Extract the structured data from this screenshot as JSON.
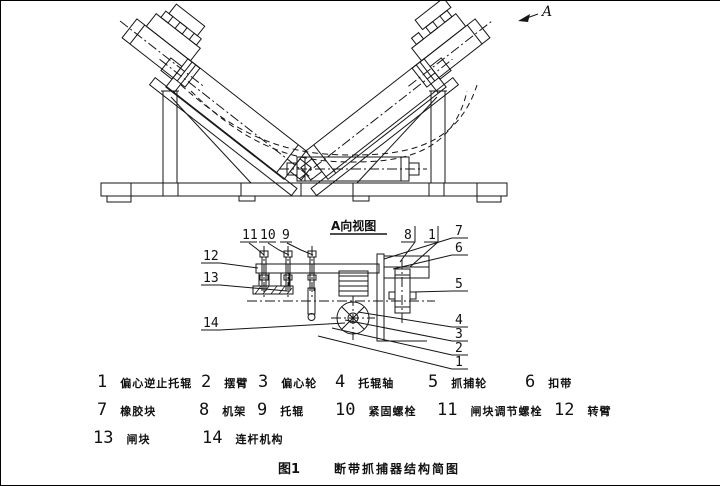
{
  "figure": {
    "fig_label": "图1",
    "title": "断带抓捕器结构简图",
    "view_label": "A向视图",
    "direction_marker": "A"
  },
  "callouts": {
    "top_left": [
      "11",
      "10",
      "9"
    ],
    "top_right": [
      "8",
      "1"
    ],
    "left": [
      "12",
      "13",
      "14"
    ],
    "right": [
      "7",
      "6",
      "5",
      "4",
      "3",
      "2",
      "1"
    ]
  },
  "legend": {
    "items": [
      {
        "num": "1",
        "label": "偏心逆止托辊"
      },
      {
        "num": "2",
        "label": "摆臂"
      },
      {
        "num": "3",
        "label": "偏心轮"
      },
      {
        "num": "4",
        "label": "托辊轴"
      },
      {
        "num": "5",
        "label": "抓捕轮"
      },
      {
        "num": "6",
        "label": "扣带"
      },
      {
        "num": "7",
        "label": "橡胶块"
      },
      {
        "num": "8",
        "label": "机架"
      },
      {
        "num": "9",
        "label": "托辊"
      },
      {
        "num": "10",
        "label": "紧固螺栓"
      },
      {
        "num": "11",
        "label": "闸块调节螺栓"
      },
      {
        "num": "12",
        "label": "转臂"
      },
      {
        "num": "13",
        "label": "闸块"
      },
      {
        "num": "14",
        "label": "连杆机构"
      }
    ]
  }
}
